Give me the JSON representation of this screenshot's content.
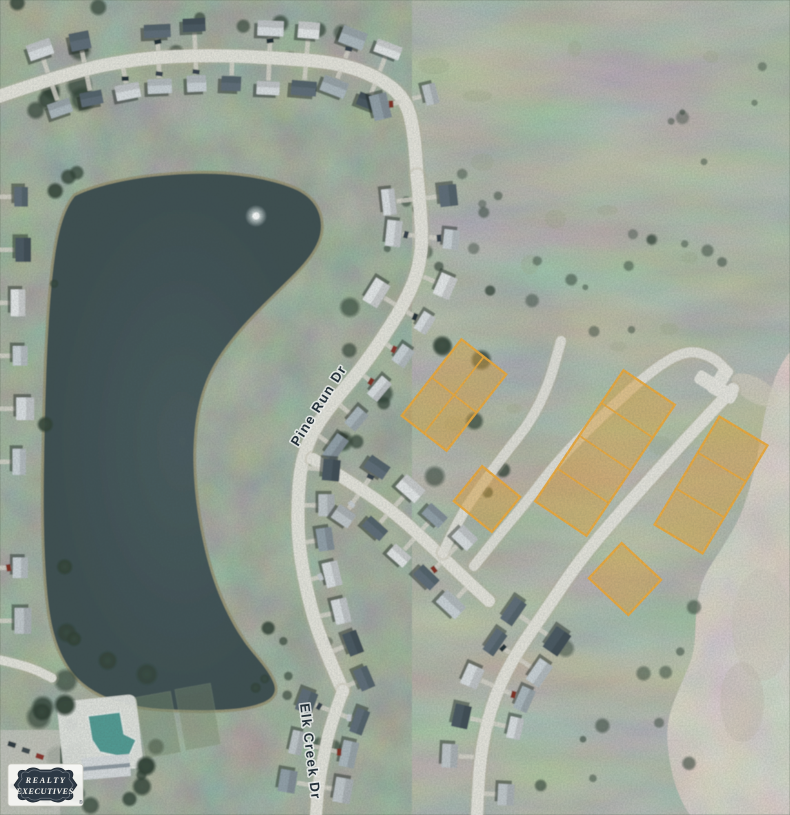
{
  "map": {
    "street_labels": [
      {
        "name": "Pine Run Dr"
      },
      {
        "name": "Elk Creek Dr"
      }
    ],
    "water": {
      "name": "pond",
      "color": "#3E5053",
      "shore_color": "#948C6A",
      "fountain": true
    },
    "terrain_colors": {
      "neighborhood_green": "#5F6E58",
      "field_green": "#75816F",
      "bare_dirt": "#ADA498",
      "road": "#E9E7E0"
    },
    "highlighted_lots": {
      "fill": "#E3A53E",
      "stroke": "#F3AB36",
      "fill_opacity": 0.5,
      "stroke_width": 2.3,
      "total_lots": 13,
      "groups": [
        {
          "id": "group-a",
          "lots": 4,
          "cx": 454,
          "cy": 395,
          "width": 57,
          "length": 97,
          "rotation": 38,
          "cols": 2,
          "rows": 2
        },
        {
          "id": "group-b",
          "lots": 1,
          "cx": 487,
          "cy": 499,
          "width": 49,
          "length": 45,
          "rotation": 39,
          "cols": 1,
          "rows": 1
        },
        {
          "id": "group-c",
          "lots": 4,
          "cx": 605,
          "cy": 453,
          "width": 62,
          "length": 158,
          "rotation": 34,
          "cols": 1,
          "rows": 4
        },
        {
          "id": "group-d",
          "lots": 3,
          "cx": 711,
          "cy": 485,
          "width": 56,
          "length": 126,
          "rotation": 31,
          "cols": 1,
          "rows": 3
        },
        {
          "id": "group-e",
          "lots": 1,
          "cx": 625,
          "cy": 579,
          "width": 54,
          "length": 48,
          "rotation": 43,
          "cols": 1,
          "rows": 1
        }
      ]
    },
    "watermark_logo": {
      "line1": "REALTY",
      "line2": "EXECUTIVES",
      "registered_mark": "®"
    }
  }
}
